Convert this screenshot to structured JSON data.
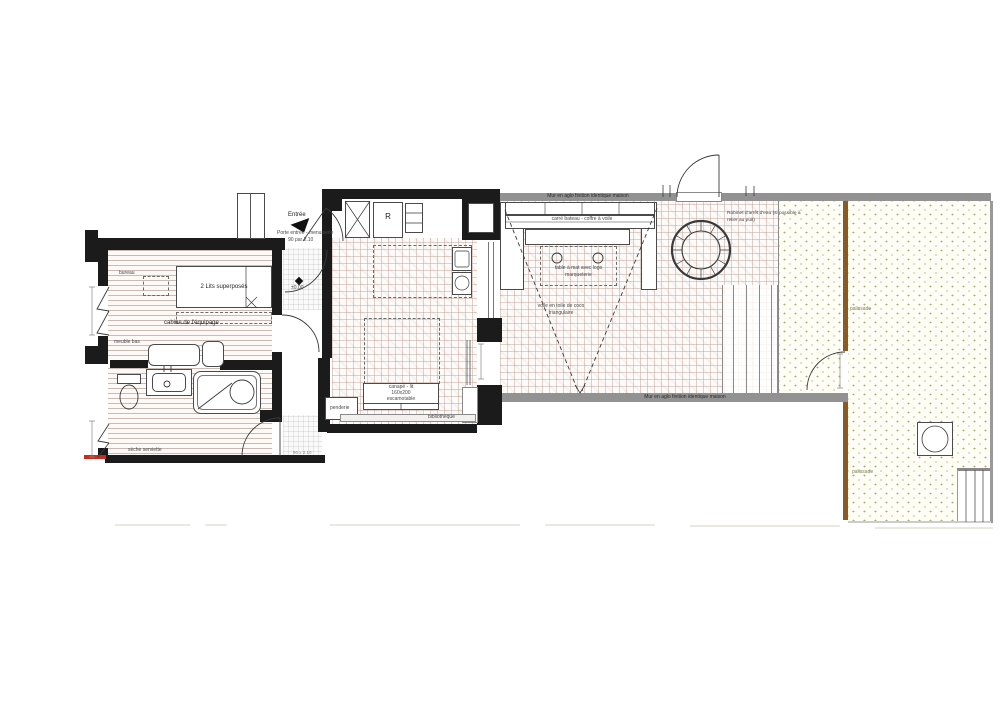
{
  "plan": {
    "bedroom": {
      "desk": "bureau",
      "bed": "2 Lits superposés",
      "room": "cabine de l'équipage",
      "cabinet": "meuble bas"
    },
    "bathroom": {
      "towel_dryer": "sèche serviette",
      "door_dim": "90 x 2.10"
    },
    "entrance": {
      "arrow": "Entrée",
      "door_line1": "Porte entrée - menuiserie",
      "door_line2": "90 par 2.10",
      "level": "±0,00"
    },
    "kitchen": {
      "fridge": "R"
    },
    "living": {
      "sofa_line1": "canapé - lit",
      "sofa_line2": "160x200",
      "sofa_line3": "escamotable",
      "wardrobe": "penderie",
      "bookshelf": "bibliothèque"
    },
    "terrace": {
      "wall_top": "Mur en aglo finition identique maison",
      "wall_bottom": "Mur en aglo finition identique maison",
      "bench": "carré bateau - coffre à voile",
      "table_line1": "table à mat avec logo",
      "table_line2": "marqueterie",
      "sail_line1": "voile en toile de coco",
      "sail_line2": "triangulaire",
      "tap_line1": "Robinet d'arrêt d'eau (si possible à",
      "tap_line2": "relier au puit)"
    },
    "garden": {
      "fence_upper": "palissade",
      "fence_lower": "palissade"
    },
    "colors": {
      "wall": "#1b1b1b",
      "concrete_wall": "#929292",
      "fence": "#8a5a22",
      "accent_red": "#cc2a1e",
      "tile_line": "#ba9c8e",
      "gravel_dot": "#948e46"
    }
  }
}
